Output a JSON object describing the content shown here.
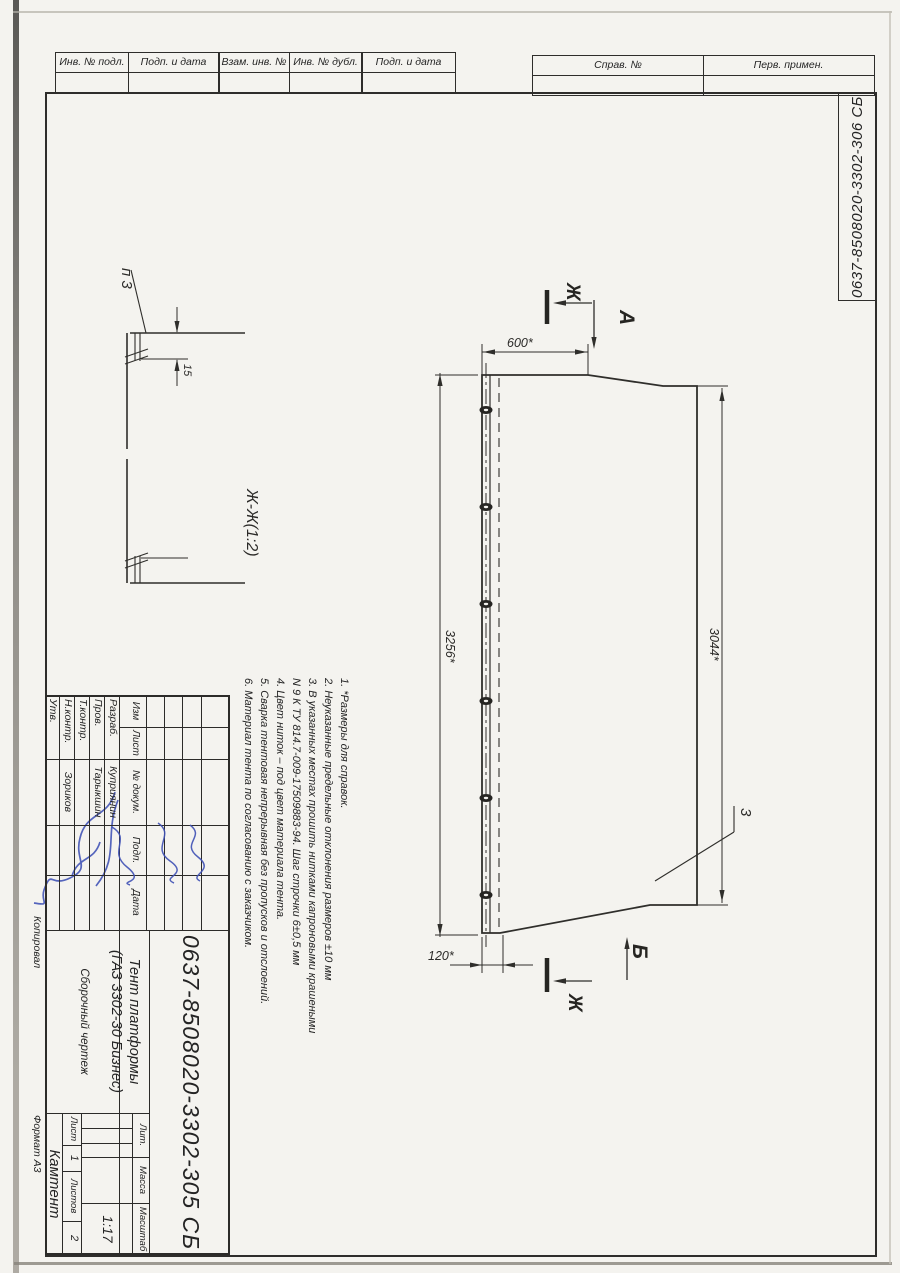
{
  "sheet": {
    "margin_stamps_left": [
      "Инв. № подл.",
      "Подп. и дата",
      "Взам. инв. №",
      "Инв. № дубл.",
      "Подп. и дата"
    ],
    "margin_stamps_right": [
      "Справ. №",
      "Перв. примен."
    ],
    "corner_doc_number": "0637-8508020-3302-306 СБ",
    "copied_label": "Копировал",
    "format_label": "Формат  А3"
  },
  "detail_view": {
    "title": "Ж-Ж(1:2)",
    "callout": "п 3",
    "hem_height": "15"
  },
  "main_view": {
    "dim_top": "600*",
    "dim_left": "3256*",
    "dim_right": "3044*",
    "dim_bottom": "120*",
    "section_letter_top": "Ж",
    "section_letter_bottom": "Ж",
    "view_arrow_top": "А",
    "view_arrow_bottom": "Б",
    "position_callout": "3"
  },
  "notes": [
    "1. *Размеры для справок.",
    "2. Неуказанные предельные отклонения размеров ±10 мм",
    "3. В указанных местах прошить нитками капроновыми крашеными",
    "N 9 К ТУ 814.7-009-17509883-94. Шаг строчки 6±0,5 мм",
    "4. Цвет ниток – под цвет материала тента.",
    "5. Сварка тентовая непрерывная без пропусков и отслоений.",
    "6. Материал тента по согласованию с заказчиком."
  ],
  "title_block": {
    "doc_number": "0637-8508020-3302-305 СБ",
    "product_title_1": "Тент платформы",
    "product_title_2": "(ГАЗ 3302-30 Бизнес)",
    "doc_type": "Сборочный чертеж",
    "company": "Камтент",
    "cols": {
      "izm": "Изм",
      "list": "Лист",
      "doc": "№ докум.",
      "sign": "Подп.",
      "date": "Дата"
    },
    "rows": [
      {
        "label": "Разраб.",
        "name": "Куприянин"
      },
      {
        "label": "Пров.",
        "name": "Тарыкшин"
      },
      {
        "label": "Т.контр.",
        "name": ""
      },
      {
        "label": "Н.контр.",
        "name": "Зориков"
      },
      {
        "label": "Утв.",
        "name": ""
      }
    ],
    "lit": "Лит.",
    "mass": "Масса",
    "scale": "Масштаб",
    "scale_value": "1:17",
    "sheet": "Лист",
    "sheet_no": "1",
    "sheets": "Листов",
    "sheets_no": "2"
  }
}
